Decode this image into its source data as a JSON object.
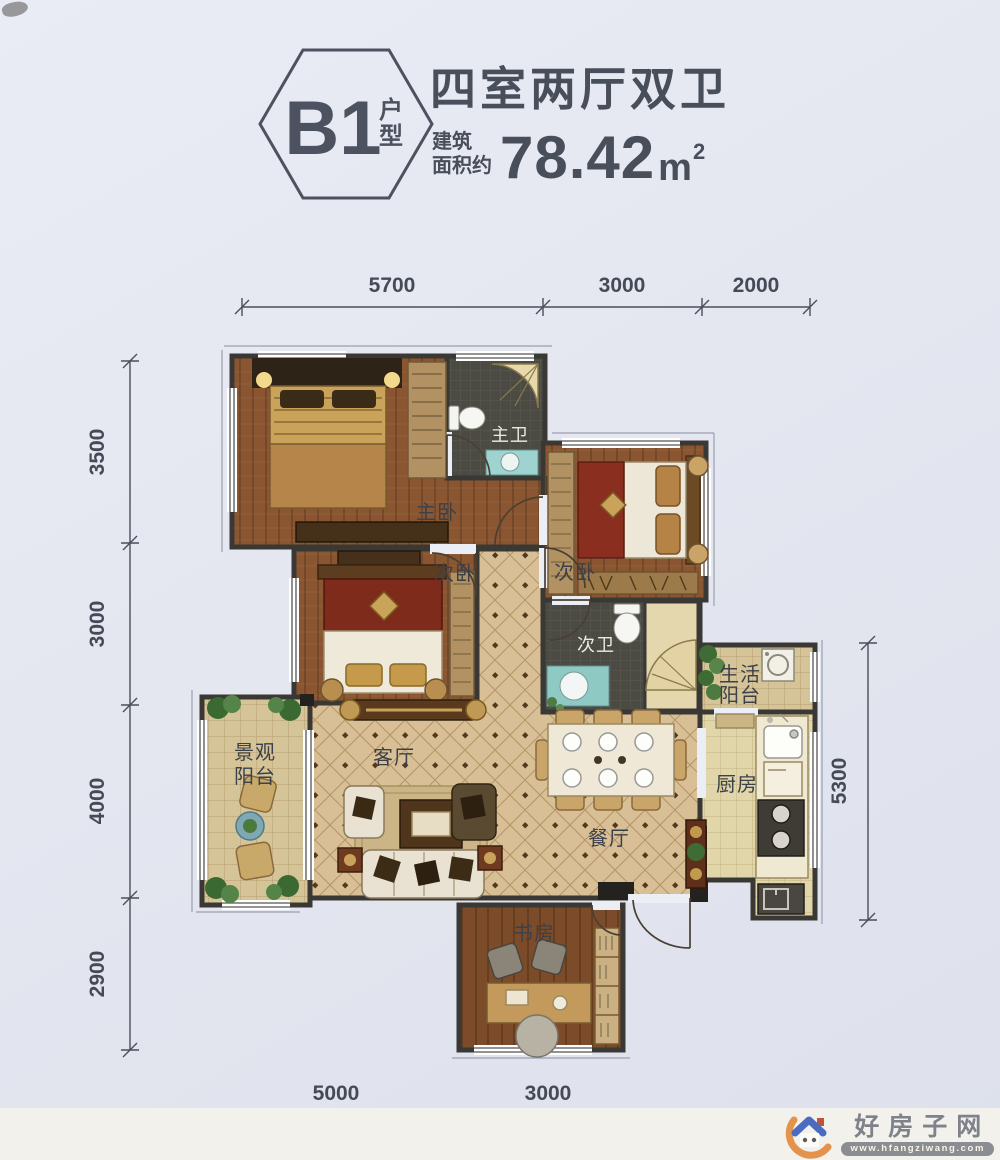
{
  "header": {
    "badge_code": "B1",
    "badge_suffix": "户型",
    "title": "四室两厅双卫",
    "area_label_line1": "建筑",
    "area_label_line2": "面积约",
    "area_value": "78.42",
    "area_unit": "m",
    "area_exponent": "2"
  },
  "dimensions": {
    "top": [
      "5700",
      "3000",
      "2000"
    ],
    "left": [
      "3500",
      "3000",
      "4000",
      "2900"
    ],
    "right": [
      "5300"
    ],
    "bottom": [
      "5000",
      "3000"
    ]
  },
  "rooms": {
    "master_bedroom": "主卧",
    "master_bath": "主卫",
    "bedroom_right": "次卧",
    "bedroom_left": "次卧",
    "second_bath": "次卫",
    "living_room": "客厅",
    "dining_room": "餐厅",
    "kitchen": "厨房",
    "study": "书房",
    "service_balcony_line1": "生活",
    "service_balcony_line2": "阳台",
    "view_balcony_line1": "景观",
    "view_balcony_line2": "阳台"
  },
  "watermark": {
    "site_name": "好房子网",
    "url": "www.hfangziwang.com"
  },
  "colors": {
    "paper": "#e4e6f0",
    "wall": "#3a3834",
    "wood_floor": "#8a5632",
    "tile_floor": "#d9bf95",
    "dark_tile": "#4b4b44",
    "logo_blue": "#4a6cc0",
    "logo_orange": "#e0832f",
    "text": "#474c59"
  }
}
